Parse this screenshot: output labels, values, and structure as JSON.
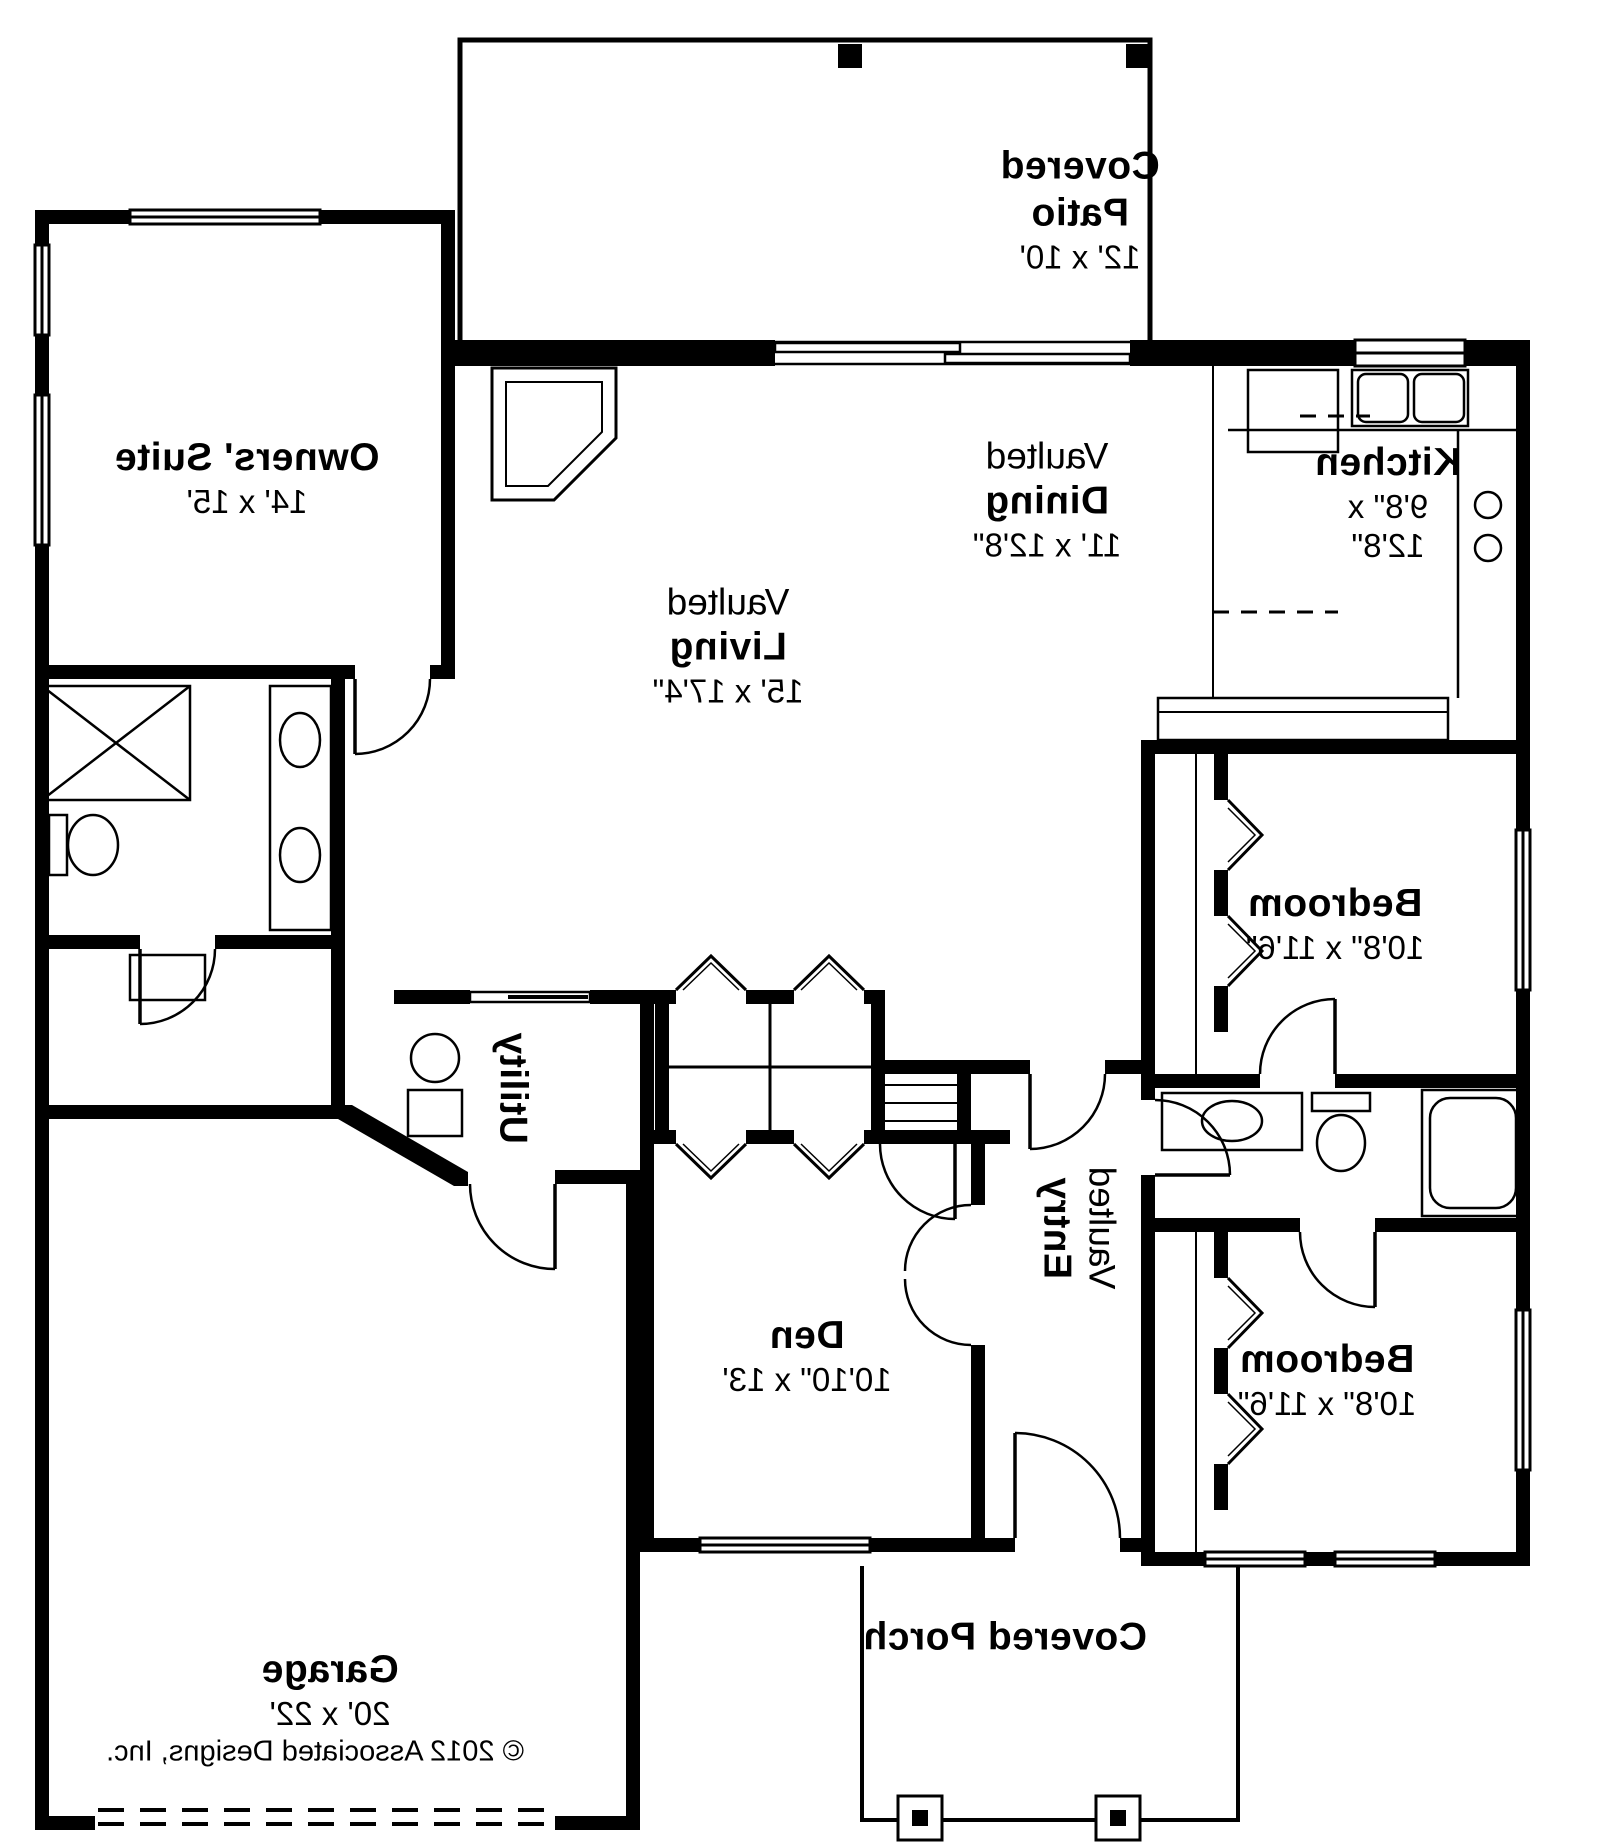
{
  "colors": {
    "line": "#000000",
    "background": "#ffffff"
  },
  "rooms": {
    "covered_patio": {
      "name_line1": "Covered",
      "name_line2": "Patio",
      "dims": "12' x 10'"
    },
    "owners_suite": {
      "name": "Owners' Suite",
      "dims": "14' x 15'"
    },
    "dining": {
      "prefix": "Vaulted",
      "name": "Dining",
      "dims": "11' x 12'8\""
    },
    "kitchen": {
      "name": "Kitchen",
      "dims_line1": "9'8\" x",
      "dims_line2": "12'8\""
    },
    "living": {
      "prefix": "Vaulted",
      "name": "Living",
      "dims": "15' x 17'4\""
    },
    "bedroom_right": {
      "name": "Bedroom",
      "dims": "10'8\" x 11'6\""
    },
    "bedroom_bottom": {
      "name": "Bedroom",
      "dims": "10'8\" x 11'6\""
    },
    "utility": {
      "name": "Utility"
    },
    "den": {
      "name": "Den",
      "dims": "10'10\" x 13'"
    },
    "entry": {
      "prefix": "Vaulted",
      "name": "Entry"
    },
    "garage": {
      "name": "Garage",
      "dims": "20' x 22'"
    },
    "covered_porch": {
      "name": "Covered Porch"
    }
  },
  "footer": {
    "copyright": "© 2012 Associated Designs, Inc."
  }
}
